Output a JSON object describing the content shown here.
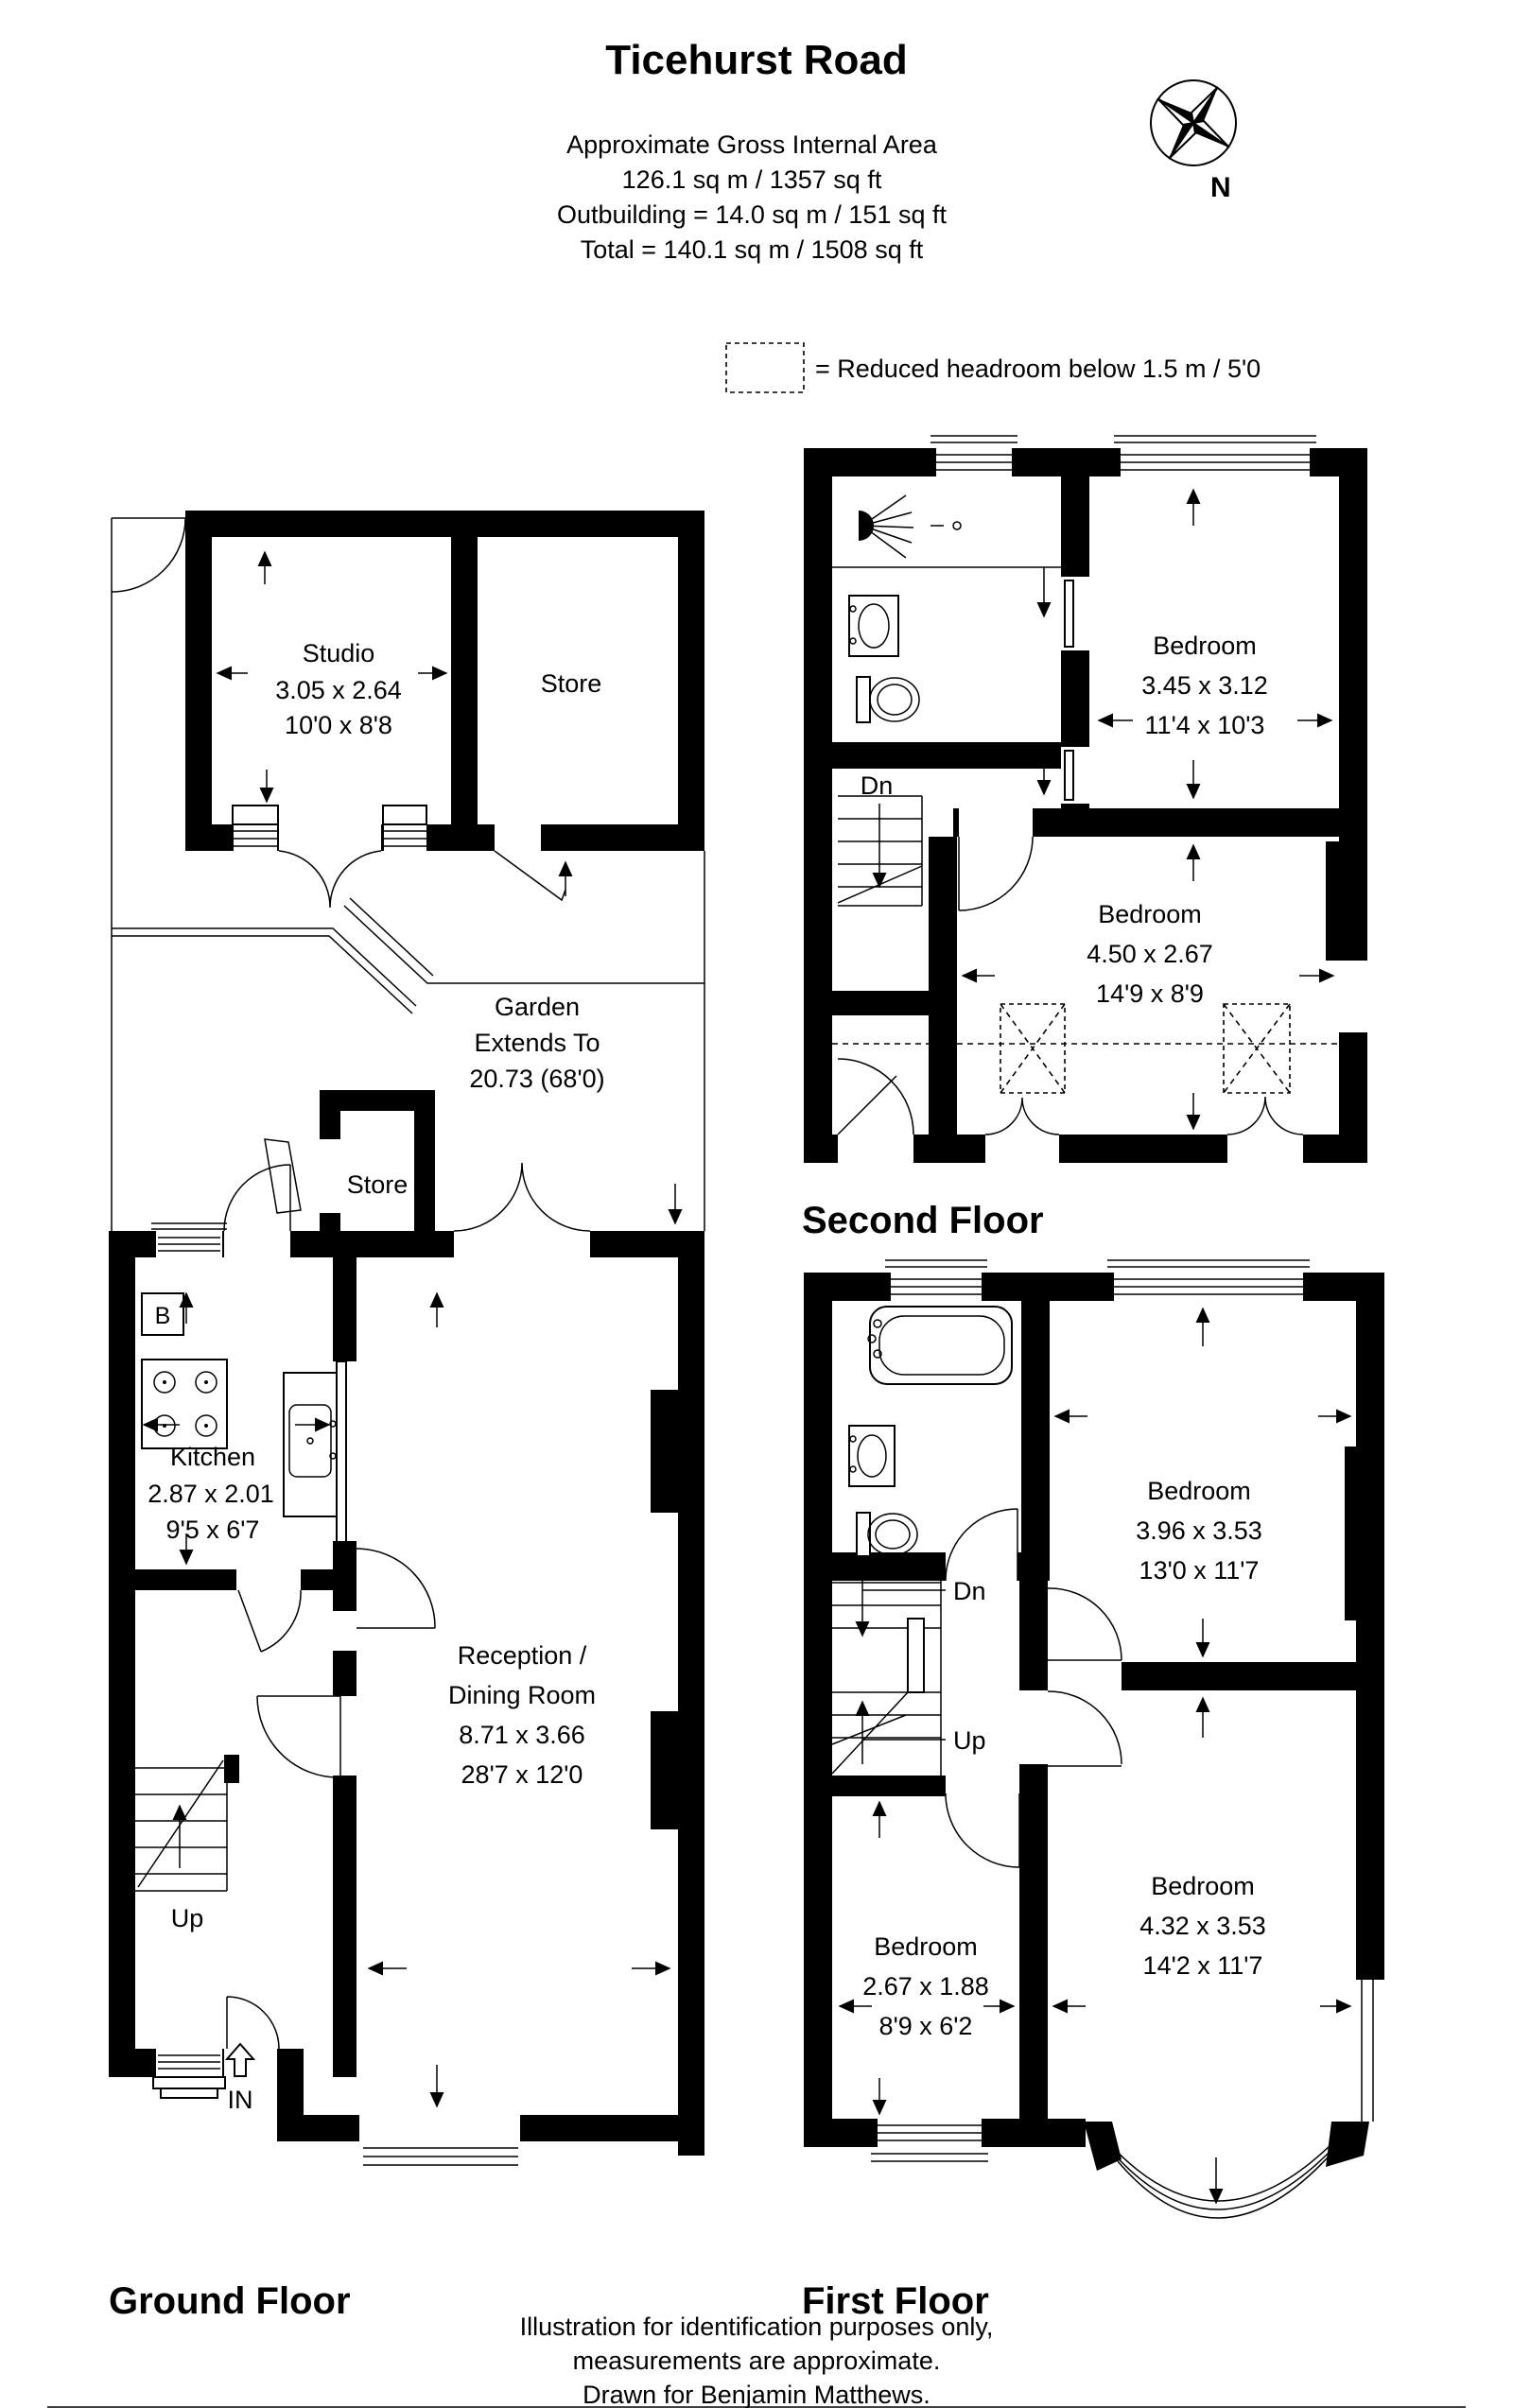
{
  "header": {
    "title": "Ticehurst Road",
    "line1": "Approximate Gross Internal Area",
    "line2": "126.1 sq m / 1357 sq ft",
    "line3": "Outbuilding = 14.0 sq m / 151 sq ft",
    "line4": "Total = 140.1 sq m / 1508 sq ft",
    "compass": "N"
  },
  "legend": {
    "text": "= Reduced headroom below 1.5 m / 5'0"
  },
  "colors": {
    "ink": "#000000",
    "paper": "#ffffff"
  },
  "outbuilding": {
    "studio": {
      "name": "Studio",
      "metric": "3.05 x 2.64",
      "imperial": "10'0 x 8'8"
    },
    "store": {
      "name": "Store"
    }
  },
  "garden": {
    "line1": "Garden",
    "line2": "Extends To",
    "line3": "20.73 (68'0)"
  },
  "ground": {
    "label": "Ground Floor",
    "store": {
      "name": "Store"
    },
    "kitchen": {
      "name": "Kitchen",
      "metric": "2.87 x 2.01",
      "imperial": "9'5 x 6'7"
    },
    "reception": {
      "name1": "Reception /",
      "name2": "Dining Room",
      "metric": "8.71 x 3.66",
      "imperial": "28'7 x 12'0"
    },
    "up": "Up",
    "entrance": "IN",
    "boiler": "B"
  },
  "first": {
    "label": "First Floor",
    "bedroom_front_large": {
      "name": "Bedroom",
      "metric": "4.32 x 3.53",
      "imperial": "14'2 x 11'7"
    },
    "bedroom_front_small": {
      "name": "Bedroom",
      "metric": "2.67 x 1.88",
      "imperial": "8'9 x 6'2"
    },
    "bedroom_rear": {
      "name": "Bedroom",
      "metric": "3.96 x 3.53",
      "imperial": "13'0 x 11'7"
    },
    "dn": "Dn",
    "up": "Up"
  },
  "second": {
    "label": "Second Floor",
    "bedroom_rear": {
      "name": "Bedroom",
      "metric": "3.45 x 3.12",
      "imperial": "11'4 x 10'3"
    },
    "bedroom_front": {
      "name": "Bedroom",
      "metric": "4.50 x 2.67",
      "imperial": "14'9 x 8'9"
    },
    "dn": "Dn"
  },
  "footer": {
    "line1": "Illustration for identification purposes only,",
    "line2": "measurements are approximate.",
    "line3": "Drawn for  Benjamin Matthews."
  }
}
